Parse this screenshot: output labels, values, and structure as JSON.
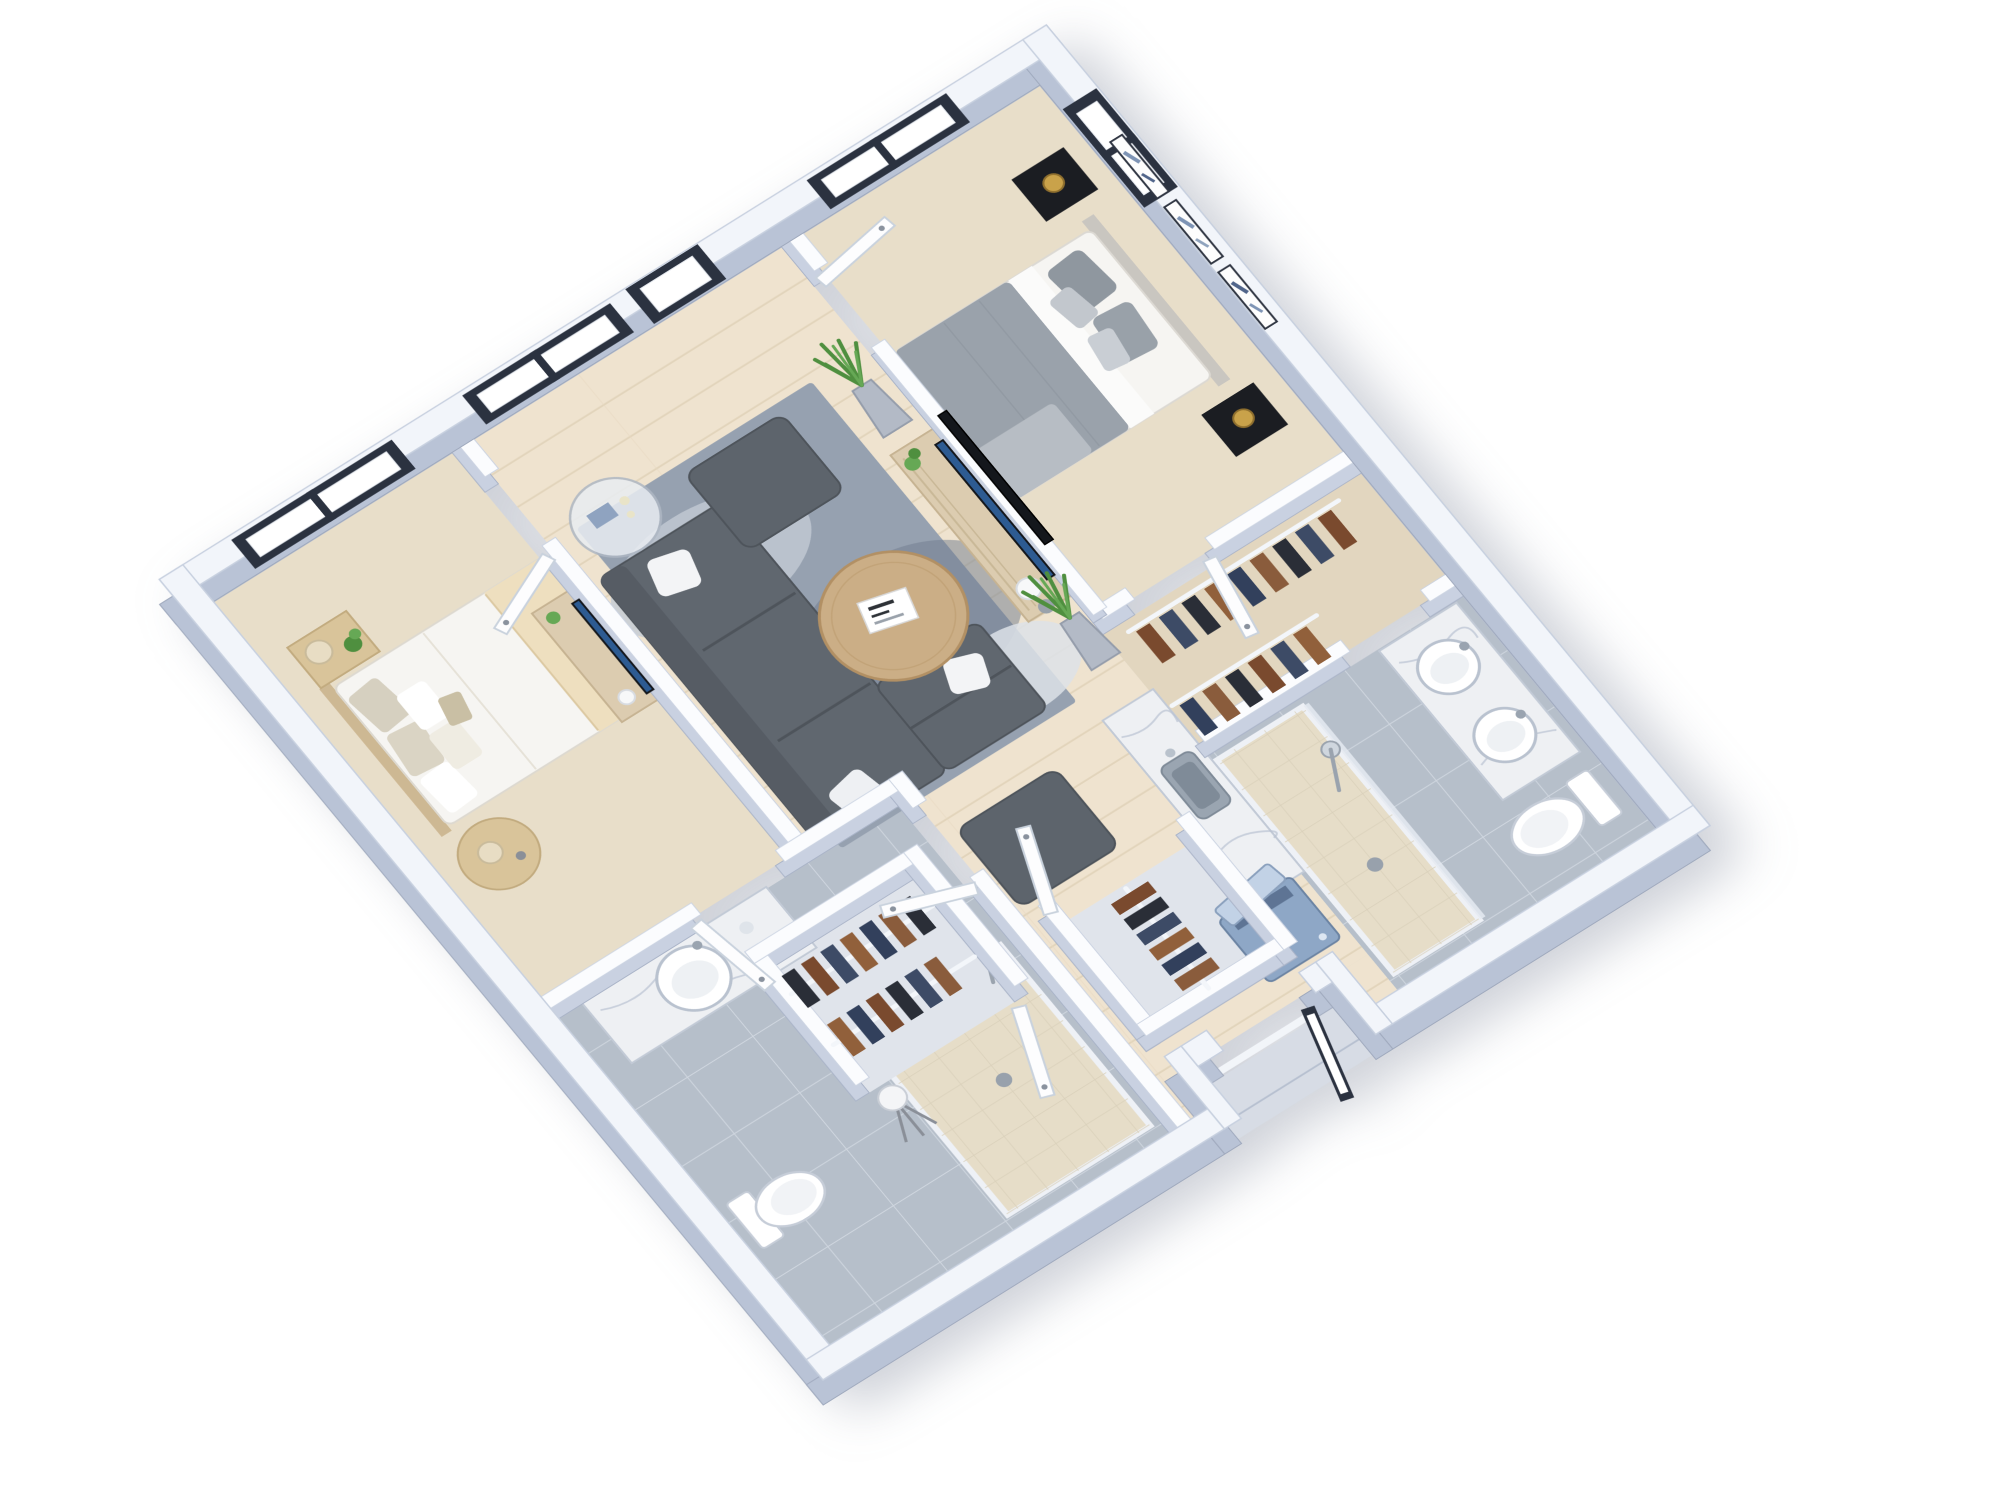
{
  "scene": {
    "title": "3D isometric floor plan render of a furnished two-bedroom apartment",
    "background": "#ffffff",
    "view": "rotated top-down axonometric, white exterior walls, no text labels",
    "bedrooms": 2,
    "bathrooms": 2
  },
  "rooms": [
    {
      "name": "Living Room",
      "floor": "light wood planks",
      "furniture": [
        "gray sectional sofa with white pillows",
        "square ottoman near window",
        "square ottoman near hall",
        "round wood coffee table with magazine",
        "blue-gray mottled area rug",
        "round glass side table with candles",
        "wood media console with TV",
        "white orb lamp and gray sphere",
        "two potted plants in gray planters"
      ]
    },
    {
      "name": "Master Bedroom",
      "floor": "beige carpet",
      "furniture": [
        "double bed with gray and white bedding",
        "padded headboard",
        "two black nightstands",
        "two brass ball lamps",
        "three black-framed abstract artworks",
        "flat TV mounted on half wall"
      ]
    },
    {
      "name": "Second Bedroom",
      "floor": "beige carpet",
      "furniture": [
        "double bed with white duvet and cream throw",
        "patterned pillows",
        "wood nightstand with cream lamp and plant",
        "round side table with cream lamp",
        "media console with TV and small plant"
      ]
    },
    {
      "name": "Master Bathroom",
      "floor": "gray tile",
      "furniture": [
        "double-sink marble vanity",
        "toilet",
        "walk-in shower with handheld sprayer and drain",
        "glass partition"
      ]
    },
    {
      "name": "Second Bathroom",
      "floor": "gray tile",
      "furniture": [
        "marble vanity with round sink",
        "toilet",
        "walk-in shower with handheld sprayer",
        "tripod lamp"
      ]
    },
    {
      "name": "Master Walk-in Closet",
      "floor": "beige carpet",
      "furniture": [
        "two white rails with hanging brown, navy and black garments"
      ]
    },
    {
      "name": "Hall Closet A",
      "floor": "gray",
      "furniture": [
        "two white rails with hanging garments",
        "open white door"
      ]
    },
    {
      "name": "Hall Closet B",
      "floor": "gray",
      "furniture": [
        "white rail with hanging garments",
        "open white door"
      ]
    },
    {
      "name": "Kitchenette",
      "floor": "light wood planks",
      "furniture": [
        "brown cabinets with marble counter",
        "steel sink with faucet",
        "blue washing machine with open lid",
        "small plant"
      ]
    },
    {
      "name": "Entry Hall",
      "floor": "light wood planks",
      "furniture": [
        "recessed entry porch",
        "dark-framed glass entry door standing open"
      ]
    }
  ],
  "openings": {
    "windows": [
      {
        "name": "second-bedroom-window",
        "wall": "upper-left",
        "panes": 2,
        "frame_color": "#2b3240"
      },
      {
        "name": "living-room-window",
        "wall": "upper-left",
        "panes": 2,
        "frame_color": "#2b3240"
      },
      {
        "name": "patio-glass-door",
        "wall": "upper-left",
        "panes": 1,
        "frame_color": "#2b3240"
      },
      {
        "name": "master-bedroom-window",
        "wall": "upper-left",
        "panes": 2,
        "frame_color": "#2b3240"
      },
      {
        "name": "master-side-window",
        "wall": "upper-right",
        "panes": 2,
        "frame_color": "#2b3240"
      }
    ],
    "doors": [
      {
        "name": "second-bedroom-door",
        "type": "white interior",
        "state": "open"
      },
      {
        "name": "second-bedroom-hall-door",
        "type": "white interior",
        "state": "open"
      },
      {
        "name": "master-bedroom-door",
        "type": "white interior",
        "state": "open"
      },
      {
        "name": "master-closet-door",
        "type": "white interior",
        "state": "open"
      },
      {
        "name": "second-bathroom-door",
        "type": "white interior",
        "state": "open"
      },
      {
        "name": "hall-closet-a-door",
        "type": "white interior",
        "state": "open"
      },
      {
        "name": "hall-closet-b-door",
        "type": "white interior",
        "state": "open"
      },
      {
        "name": "entry-door",
        "type": "dark-framed glass",
        "state": "open"
      }
    ]
  },
  "palette": {
    "wallTop": "#f2f5fa",
    "wallSide": "#b9c3d6",
    "innerWallTop": "#fbfcfe",
    "innerWallSide": "#c9d1e1",
    "windowFrame": "#2b3240",
    "glass": "#ffffff",
    "wood": "#efe3cf",
    "carpet": "#e8dec9",
    "carpetCloset": "#e2d6bf",
    "tile": "#b6bfca",
    "showerPan": "#e6ddc8",
    "closetFloor": "#e0e4eb",
    "porch": "#d7dce5",
    "rug": "#96a1b0",
    "sofa": "#60676f",
    "ottoman": "#5d646c",
    "coffeeTable": "#cbae86",
    "console": "#dcccb0",
    "tvScreen": "#2d5b92",
    "tvDark": "#14171c",
    "marble": "#eef0f3",
    "cabinets": "#6d5a4c",
    "washer": "#8ea7c6",
    "washerLid": "#c2d2e6",
    "bedWhite": "#f6f5f2",
    "bedCream": "#eedfbf",
    "bedGray": "#9aa2ab",
    "pillowGray": "#8f979f",
    "nightstandBlack": "#1b1d22",
    "nightstandWood": "#d9c49a",
    "lampGold": "#c9a24a",
    "lampCream": "#e8ddc4",
    "plant": "#4f8f3f",
    "plantLight": "#66a855",
    "porcelain": "#ffffff",
    "chrome": "#cfd6de",
    "clothes": [
      "#7a4a2e",
      "#3d4b66",
      "#2a2e37",
      "#91603b",
      "#32405c",
      "#8a5c3c"
    ]
  }
}
